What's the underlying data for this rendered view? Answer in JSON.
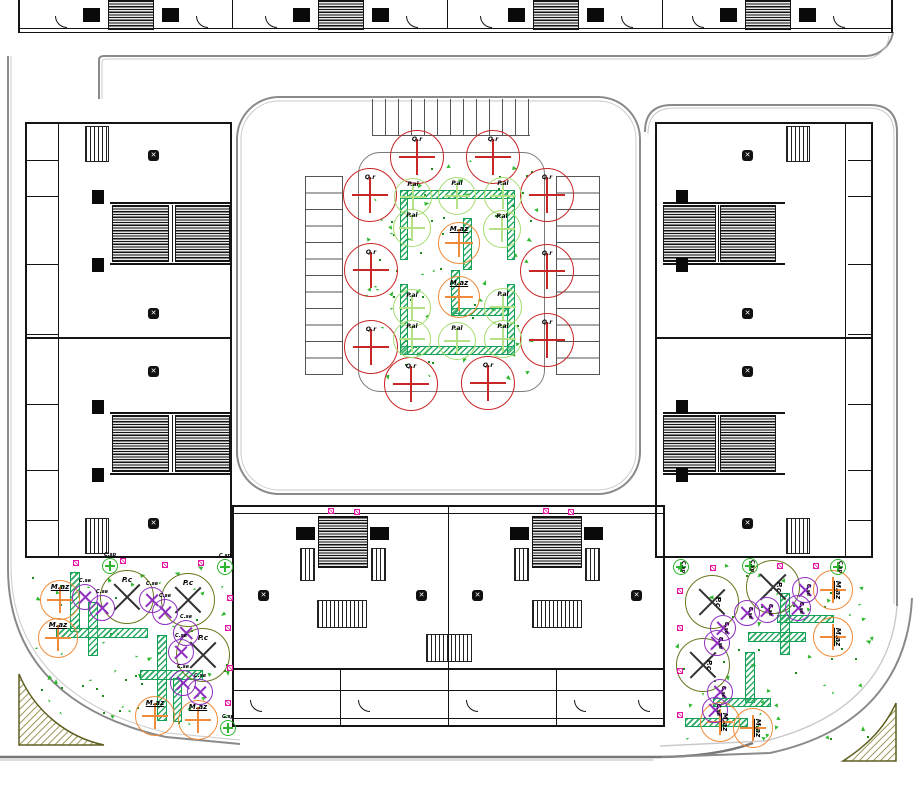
{
  "species": {
    "Q.r": {
      "color": "#c92727",
      "mark": "plus",
      "markColor": "#c92727",
      "r": 27,
      "font": 6
    },
    "P.al": {
      "color": "#a6dc72",
      "mark": "plus",
      "markColor": "#b5e286",
      "r": 19,
      "font": 6
    },
    "M.az": {
      "color": "#ef8b3a",
      "mark": "plus",
      "markColor": "#ef8b3a",
      "r": 20,
      "font": 7,
      "underline": true
    },
    "P.c": {
      "color": "#6b761f",
      "mark": "x",
      "markColor": "#333333",
      "r": 27,
      "font": 7
    },
    "C.se": {
      "color": "#9030c0",
      "mark": "x",
      "markColor": "#9030c0",
      "r": 13,
      "font": 5
    },
    "C.sp": {
      "color": "#2db52d",
      "mark": "plus",
      "markColor": "#2db52d",
      "r": 8,
      "font": 5
    }
  },
  "trees": [
    {
      "s": "Q.r",
      "x": 417,
      "y": 157
    },
    {
      "s": "Q.r",
      "x": 493,
      "y": 157
    },
    {
      "s": "Q.r",
      "x": 370,
      "y": 195
    },
    {
      "s": "Q.r",
      "x": 547,
      "y": 195
    },
    {
      "s": "Q.r",
      "x": 371,
      "y": 270
    },
    {
      "s": "Q.r",
      "x": 547,
      "y": 271
    },
    {
      "s": "Q.r",
      "x": 371,
      "y": 347
    },
    {
      "s": "Q.r",
      "x": 547,
      "y": 340
    },
    {
      "s": "Q.r",
      "x": 411,
      "y": 384
    },
    {
      "s": "Q.r",
      "x": 488,
      "y": 383
    },
    {
      "s": "P.al",
      "x": 413,
      "y": 197
    },
    {
      "s": "P.al",
      "x": 457,
      "y": 196
    },
    {
      "s": "P.al",
      "x": 503,
      "y": 196
    },
    {
      "s": "P.al",
      "x": 412,
      "y": 228
    },
    {
      "s": "P.al",
      "x": 502,
      "y": 229
    },
    {
      "s": "P.al",
      "x": 412,
      "y": 308
    },
    {
      "s": "P.al",
      "x": 503,
      "y": 307
    },
    {
      "s": "P.al",
      "x": 412,
      "y": 339
    },
    {
      "s": "P.al",
      "x": 457,
      "y": 341
    },
    {
      "s": "P.al",
      "x": 503,
      "y": 339
    },
    {
      "s": "M.az",
      "x": 459,
      "y": 243,
      "r": 21
    },
    {
      "s": "M.az",
      "x": 459,
      "y": 297,
      "r": 21
    },
    {
      "s": "M.az",
      "x": 60,
      "y": 600
    },
    {
      "s": "M.az",
      "x": 58,
      "y": 638
    },
    {
      "s": "M.az",
      "x": 155,
      "y": 716
    },
    {
      "s": "M.az",
      "x": 198,
      "y": 720
    },
    {
      "s": "P.c",
      "x": 127,
      "y": 597
    },
    {
      "s": "P.c",
      "x": 188,
      "y": 600
    },
    {
      "s": "P.c",
      "x": 203,
      "y": 655
    },
    {
      "s": "C.se",
      "x": 85,
      "y": 597
    },
    {
      "s": "C.se",
      "x": 102,
      "y": 608
    },
    {
      "s": "C.se",
      "x": 152,
      "y": 600
    },
    {
      "s": "C.se",
      "x": 165,
      "y": 612
    },
    {
      "s": "C.se",
      "x": 186,
      "y": 633
    },
    {
      "s": "C.se",
      "x": 181,
      "y": 652
    },
    {
      "s": "C.se",
      "x": 183,
      "y": 683
    },
    {
      "s": "C.se",
      "x": 200,
      "y": 692
    },
    {
      "s": "C.sp",
      "x": 110,
      "y": 566
    },
    {
      "s": "C.sp",
      "x": 225,
      "y": 567
    },
    {
      "s": "C.sp",
      "x": 228,
      "y": 728
    },
    {
      "s": "M.az",
      "x": 833,
      "y": 590,
      "rot": 1
    },
    {
      "s": "M.az",
      "x": 833,
      "y": 637,
      "rot": 1
    },
    {
      "s": "M.az",
      "x": 720,
      "y": 722,
      "rot": 1
    },
    {
      "s": "M.az",
      "x": 753,
      "y": 728,
      "rot": 1
    },
    {
      "s": "P.c",
      "x": 712,
      "y": 602,
      "rot": 1
    },
    {
      "s": "P.c",
      "x": 703,
      "y": 665,
      "rot": 1
    },
    {
      "s": "P.c",
      "x": 773,
      "y": 587,
      "rot": 1
    },
    {
      "s": "C.se",
      "x": 747,
      "y": 613,
      "rot": 1
    },
    {
      "s": "C.se",
      "x": 767,
      "y": 610,
      "rot": 1
    },
    {
      "s": "C.se",
      "x": 805,
      "y": 590,
      "rot": 1
    },
    {
      "s": "C.se",
      "x": 798,
      "y": 608,
      "rot": 1
    },
    {
      "s": "C.se",
      "x": 723,
      "y": 628,
      "rot": 1
    },
    {
      "s": "C.se",
      "x": 717,
      "y": 643,
      "rot": 1
    },
    {
      "s": "C.se",
      "x": 720,
      "y": 692,
      "rot": 1
    },
    {
      "s": "C.se",
      "x": 715,
      "y": 710,
      "rot": 1
    },
    {
      "s": "C.sp",
      "x": 681,
      "y": 567,
      "rot": 1
    },
    {
      "s": "C.sp",
      "x": 750,
      "y": 566,
      "rot": 1
    },
    {
      "s": "C.sp",
      "x": 838,
      "y": 567,
      "rot": 1
    }
  ],
  "planters": [
    [
      400,
      190,
      115,
      9
    ],
    [
      400,
      190,
      8,
      70
    ],
    [
      507,
      190,
      8,
      70
    ],
    [
      463,
      218,
      9,
      52
    ],
    [
      400,
      346,
      115,
      9
    ],
    [
      400,
      284,
      8,
      71
    ],
    [
      507,
      284,
      8,
      71
    ],
    [
      451,
      270,
      9,
      44
    ],
    [
      451,
      308,
      58,
      8
    ],
    [
      70,
      572,
      10,
      60
    ],
    [
      88,
      602,
      10,
      54
    ],
    [
      56,
      628,
      92,
      10
    ],
    [
      157,
      635,
      10,
      86
    ],
    [
      140,
      670,
      63,
      10
    ],
    [
      173,
      678,
      9,
      44
    ],
    [
      780,
      593,
      10,
      62
    ],
    [
      777,
      615,
      57,
      8
    ],
    [
      748,
      632,
      58,
      10
    ],
    [
      745,
      652,
      10,
      51
    ],
    [
      713,
      698,
      58,
      9
    ],
    [
      685,
      718,
      63,
      9
    ]
  ],
  "utility_markers": [
    [
      73,
      560
    ],
    [
      120,
      558
    ],
    [
      162,
      562
    ],
    [
      198,
      560
    ],
    [
      227,
      595
    ],
    [
      225,
      625
    ],
    [
      227,
      665
    ],
    [
      225,
      700
    ],
    [
      328,
      508
    ],
    [
      354,
      509
    ],
    [
      543,
      508
    ],
    [
      568,
      509
    ],
    [
      710,
      565
    ],
    [
      777,
      563
    ],
    [
      813,
      563
    ],
    [
      677,
      588
    ],
    [
      677,
      625
    ],
    [
      677,
      668
    ],
    [
      677,
      712
    ]
  ],
  "ground_cover": {
    "triangle_color": "#2eb82e",
    "dot_color": "#1d8a1d",
    "regions": [
      {
        "x": 365,
        "y": 158,
        "w": 175,
        "h": 228,
        "n": 80,
        "seed": 7
      },
      {
        "x": 32,
        "y": 560,
        "w": 196,
        "h": 165,
        "n": 62,
        "seed": 13
      },
      {
        "x": 676,
        "y": 560,
        "w": 196,
        "h": 178,
        "n": 62,
        "seed": 29
      }
    ]
  },
  "palette": {
    "road": "#8a8a8a",
    "road_echo": "#c9c9c9",
    "building": "#141414",
    "courtyard_border": "#7a7a7a",
    "planter_border": "#12a157",
    "planter_hatch": "#2bab62",
    "island_hatch": "#7c7c28",
    "island_border": "#5f5f22",
    "marker": "#e515a5"
  }
}
